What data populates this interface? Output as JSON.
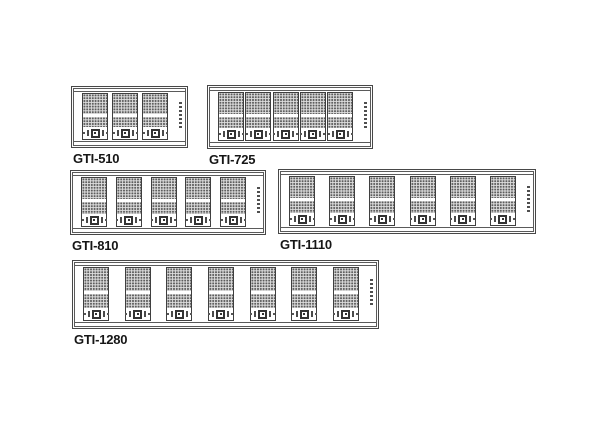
{
  "figure": {
    "description_title": "",
    "background_color": "#ffffff"
  },
  "colors": {
    "line": "#474747",
    "inner_line": "#5a5a5a",
    "module_border": "#3f3f3f",
    "dot_fill": "#5c5c5c",
    "dot_area_bg": "#dedede",
    "label_text": "#161616"
  },
  "tick_marks_per_strip": 7,
  "panels": [
    {
      "label": "GTI-510",
      "module_count": 3
    },
    {
      "label": "GTI-725",
      "module_count": 5
    },
    {
      "label": "GTI-810",
      "module_count": 5
    },
    {
      "label": "GTI-1110",
      "module_count": 6
    },
    {
      "label": "GTI-1280",
      "module_count": 7
    }
  ]
}
